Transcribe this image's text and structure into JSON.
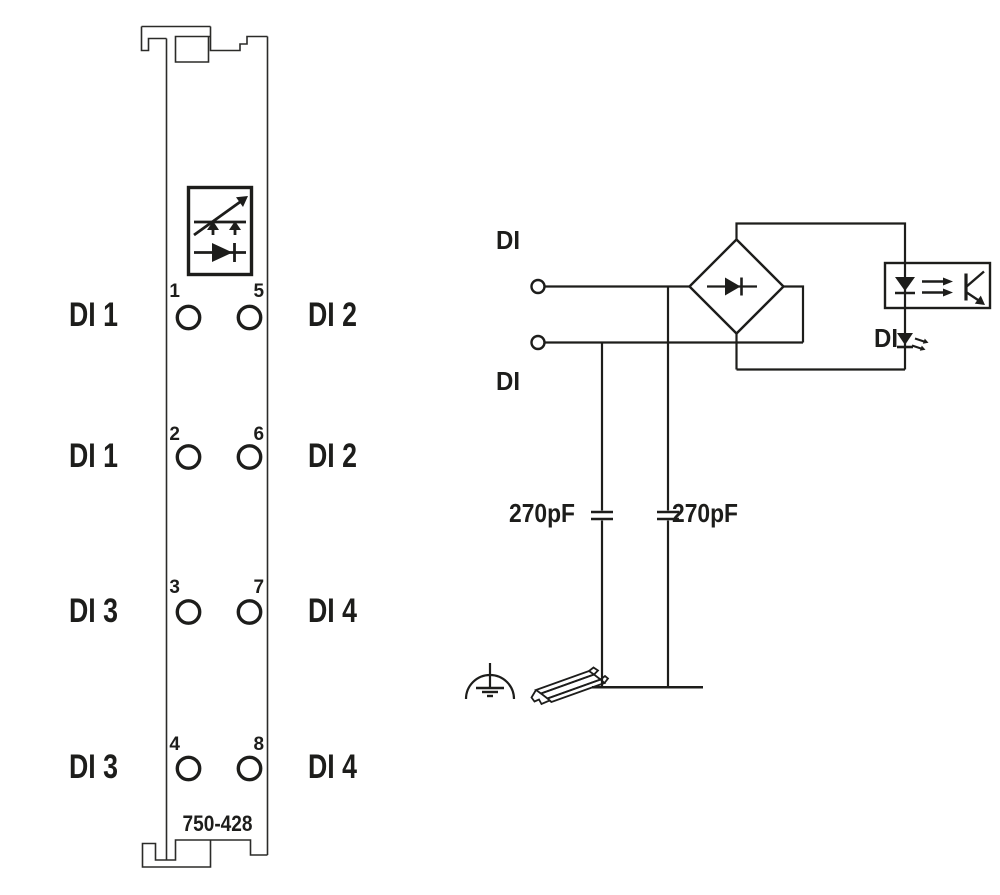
{
  "colors": {
    "line": "#1d1d1b",
    "module_outline": "#2b2b29",
    "background": "#ffffff"
  },
  "module": {
    "part_number": "750-428",
    "rows": [
      {
        "left_label": "DI 1",
        "left_terminal": "1",
        "right_terminal": "5",
        "right_label": "DI 2"
      },
      {
        "left_label": "DI 1",
        "left_terminal": "2",
        "right_terminal": "6",
        "right_label": "DI 2"
      },
      {
        "left_label": "DI 3",
        "left_terminal": "3",
        "right_terminal": "7",
        "right_label": "DI 4"
      },
      {
        "left_label": "DI 3",
        "left_terminal": "4",
        "right_terminal": "8",
        "right_label": "DI 4"
      }
    ]
  },
  "schematic": {
    "input_top_label": "DI",
    "input_bottom_label": "DI",
    "capacitor_left": "270pF",
    "capacitor_right": "270pF",
    "status_led_label": "DI"
  }
}
